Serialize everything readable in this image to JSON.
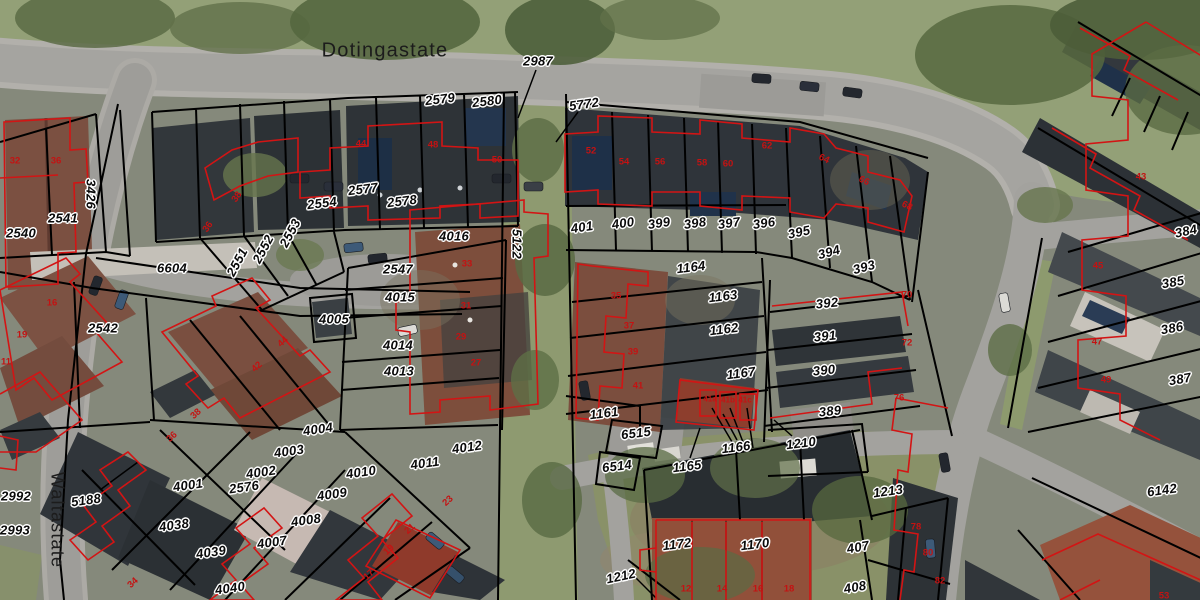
{
  "map": {
    "streets": [
      {
        "t": "Dotingastate",
        "x": 385,
        "y": 51,
        "r": 0,
        "fs": 20
      },
      {
        "t": "Waltastate",
        "x": 57,
        "y": 520,
        "r": 90,
        "fs": 18
      }
    ],
    "parcel_labels": [
      {
        "t": "2987",
        "x": 538,
        "y": 61
      },
      {
        "t": "2579",
        "x": 440,
        "y": 99,
        "r": -7
      },
      {
        "t": "2580",
        "x": 487,
        "y": 101,
        "r": -7
      },
      {
        "t": "5772",
        "x": 584,
        "y": 104,
        "r": -8
      },
      {
        "t": "2577",
        "x": 363,
        "y": 189,
        "r": -7
      },
      {
        "t": "2578",
        "x": 402,
        "y": 201,
        "r": -7
      },
      {
        "t": "2554",
        "x": 322,
        "y": 203,
        "r": -7
      },
      {
        "t": "2553",
        "x": 290,
        "y": 233,
        "r": -62
      },
      {
        "t": "2552",
        "x": 263,
        "y": 249,
        "r": -62
      },
      {
        "t": "2551",
        "x": 237,
        "y": 262,
        "r": -62
      },
      {
        "t": "2541",
        "x": 63,
        "y": 218
      },
      {
        "t": "2540",
        "x": 21,
        "y": 233
      },
      {
        "t": "3426",
        "x": 91,
        "y": 194,
        "r": 90
      },
      {
        "t": "6604",
        "x": 172,
        "y": 268
      },
      {
        "t": "2542",
        "x": 103,
        "y": 328
      },
      {
        "t": "2547",
        "x": 398,
        "y": 269
      },
      {
        "t": "4016",
        "x": 454,
        "y": 236
      },
      {
        "t": "4015",
        "x": 400,
        "y": 297
      },
      {
        "t": "4005",
        "x": 334,
        "y": 319
      },
      {
        "t": "4014",
        "x": 398,
        "y": 345
      },
      {
        "t": "4013",
        "x": 399,
        "y": 371
      },
      {
        "t": "5122",
        "x": 517,
        "y": 244,
        "r": 90
      },
      {
        "t": "401",
        "x": 582,
        "y": 227,
        "r": -8
      },
      {
        "t": "400",
        "x": 623,
        "y": 223,
        "r": -8
      },
      {
        "t": "399",
        "x": 659,
        "y": 223,
        "r": -8
      },
      {
        "t": "398",
        "x": 695,
        "y": 223,
        "r": -8
      },
      {
        "t": "397",
        "x": 729,
        "y": 223,
        "r": -8
      },
      {
        "t": "396",
        "x": 764,
        "y": 223,
        "r": -8
      },
      {
        "t": "395",
        "x": 799,
        "y": 232,
        "r": -12
      },
      {
        "t": "394",
        "x": 829,
        "y": 252,
        "r": -15
      },
      {
        "t": "393",
        "x": 864,
        "y": 267,
        "r": -15
      },
      {
        "t": "392",
        "x": 827,
        "y": 303,
        "r": -6
      },
      {
        "t": "391",
        "x": 825,
        "y": 336,
        "r": -6
      },
      {
        "t": "390",
        "x": 824,
        "y": 370,
        "r": -6
      },
      {
        "t": "389",
        "x": 830,
        "y": 411,
        "r": -6
      },
      {
        "t": "1164",
        "x": 691,
        "y": 267,
        "r": -7
      },
      {
        "t": "1163",
        "x": 723,
        "y": 296,
        "r": -7
      },
      {
        "t": "1162",
        "x": 724,
        "y": 329,
        "r": -7
      },
      {
        "t": "1167",
        "x": 741,
        "y": 373,
        "r": -7
      },
      {
        "t": "1161",
        "x": 604,
        "y": 413,
        "r": -7
      },
      {
        "t": "6515",
        "x": 636,
        "y": 433,
        "r": -7
      },
      {
        "t": "6514",
        "x": 617,
        "y": 466,
        "r": -7
      },
      {
        "t": "1165",
        "x": 687,
        "y": 466,
        "r": -7
      },
      {
        "t": "1166",
        "x": 736,
        "y": 447,
        "r": -7
      },
      {
        "t": "1210",
        "x": 801,
        "y": 443,
        "r": -7
      },
      {
        "t": "1172",
        "x": 677,
        "y": 544,
        "r": -7
      },
      {
        "t": "1170",
        "x": 755,
        "y": 544,
        "r": -7
      },
      {
        "t": "1212",
        "x": 621,
        "y": 576,
        "r": -12
      },
      {
        "t": "407",
        "x": 858,
        "y": 547,
        "r": -10
      },
      {
        "t": "408",
        "x": 855,
        "y": 587,
        "r": -10
      },
      {
        "t": "1213",
        "x": 888,
        "y": 491,
        "r": -8
      },
      {
        "t": "6142",
        "x": 1162,
        "y": 490,
        "r": -8
      },
      {
        "t": "384",
        "x": 1186,
        "y": 231,
        "r": -12
      },
      {
        "t": "385",
        "x": 1173,
        "y": 282,
        "r": -10
      },
      {
        "t": "386",
        "x": 1172,
        "y": 328,
        "r": -10
      },
      {
        "t": "387",
        "x": 1180,
        "y": 379,
        "r": -10
      },
      {
        "t": "2992",
        "x": 16,
        "y": 496
      },
      {
        "t": "2993",
        "x": 15,
        "y": 530
      },
      {
        "t": "5188",
        "x": 86,
        "y": 500,
        "r": -8
      },
      {
        "t": "4001",
        "x": 188,
        "y": 485,
        "r": -8
      },
      {
        "t": "2576",
        "x": 244,
        "y": 487,
        "r": -8
      },
      {
        "t": "4038",
        "x": 174,
        "y": 525,
        "r": -8
      },
      {
        "t": "4039",
        "x": 211,
        "y": 552,
        "r": -8
      },
      {
        "t": "4040",
        "x": 230,
        "y": 588,
        "r": -8
      },
      {
        "t": "4004",
        "x": 318,
        "y": 429,
        "r": -8
      },
      {
        "t": "4003",
        "x": 289,
        "y": 451,
        "r": -8
      },
      {
        "t": "4002",
        "x": 261,
        "y": 472,
        "r": -8
      },
      {
        "t": "4007",
        "x": 272,
        "y": 542,
        "r": -8
      },
      {
        "t": "4008",
        "x": 306,
        "y": 520,
        "r": -8
      },
      {
        "t": "4009",
        "x": 332,
        "y": 494,
        "r": -8
      },
      {
        "t": "4010",
        "x": 361,
        "y": 472,
        "r": -8
      },
      {
        "t": "4011",
        "x": 425,
        "y": 463,
        "r": -8
      },
      {
        "t": "4012",
        "x": 467,
        "y": 447,
        "r": -8
      }
    ],
    "house_numbers": [
      {
        "t": "32",
        "x": 15,
        "y": 161
      },
      {
        "t": "36",
        "x": 56,
        "y": 161
      },
      {
        "t": "44",
        "x": 361,
        "y": 144
      },
      {
        "t": "48",
        "x": 433,
        "y": 145
      },
      {
        "t": "50",
        "x": 497,
        "y": 160
      },
      {
        "t": "52",
        "x": 591,
        "y": 151
      },
      {
        "t": "54",
        "x": 624,
        "y": 162
      },
      {
        "t": "56",
        "x": 660,
        "y": 162
      },
      {
        "t": "58",
        "x": 702,
        "y": 163
      },
      {
        "t": "60",
        "x": 728,
        "y": 164
      },
      {
        "t": "62",
        "x": 767,
        "y": 146
      },
      {
        "t": "64",
        "x": 824,
        "y": 159,
        "r": 25
      },
      {
        "t": "66",
        "x": 864,
        "y": 181,
        "r": 25
      },
      {
        "t": "68",
        "x": 907,
        "y": 206,
        "r": 25
      },
      {
        "t": "70",
        "x": 907,
        "y": 295
      },
      {
        "t": "72",
        "x": 907,
        "y": 343
      },
      {
        "t": "76",
        "x": 899,
        "y": 398
      },
      {
        "t": "78",
        "x": 916,
        "y": 527
      },
      {
        "t": "80",
        "x": 928,
        "y": 553
      },
      {
        "t": "82",
        "x": 940,
        "y": 581
      },
      {
        "t": "38",
        "x": 237,
        "y": 197,
        "r": -55
      },
      {
        "t": "36",
        "x": 208,
        "y": 227,
        "r": -55
      },
      {
        "t": "44",
        "x": 283,
        "y": 342,
        "r": -42
      },
      {
        "t": "42",
        "x": 257,
        "y": 367,
        "r": -42
      },
      {
        "t": "16",
        "x": 52,
        "y": 303
      },
      {
        "t": "19",
        "x": 22,
        "y": 335
      },
      {
        "t": "11",
        "x": 6,
        "y": 362
      },
      {
        "t": "33",
        "x": 467,
        "y": 264
      },
      {
        "t": "31",
        "x": 466,
        "y": 306
      },
      {
        "t": "29",
        "x": 461,
        "y": 337
      },
      {
        "t": "27",
        "x": 476,
        "y": 363
      },
      {
        "t": "35",
        "x": 616,
        "y": 296
      },
      {
        "t": "37",
        "x": 629,
        "y": 326
      },
      {
        "t": "39",
        "x": 633,
        "y": 352
      },
      {
        "t": "41",
        "x": 638,
        "y": 386
      },
      {
        "t": "41a",
        "x": 710,
        "y": 399,
        "fs": 8
      },
      {
        "t": "41b",
        "x": 728,
        "y": 400,
        "fs": 8
      },
      {
        "t": "41c",
        "x": 745,
        "y": 400,
        "fs": 8
      },
      {
        "t": "23",
        "x": 448,
        "y": 501,
        "r": -42
      },
      {
        "t": "21",
        "x": 410,
        "y": 529,
        "r": -42
      },
      {
        "t": "19",
        "x": 389,
        "y": 550,
        "r": -42
      },
      {
        "t": "17",
        "x": 369,
        "y": 575,
        "r": -42
      },
      {
        "t": "38",
        "x": 196,
        "y": 414,
        "r": -42
      },
      {
        "t": "36",
        "x": 172,
        "y": 437,
        "r": -42
      },
      {
        "t": "34",
        "x": 133,
        "y": 583,
        "r": -42
      },
      {
        "t": "12",
        "x": 686,
        "y": 589
      },
      {
        "t": "14",
        "x": 722,
        "y": 589
      },
      {
        "t": "16",
        "x": 758,
        "y": 589
      },
      {
        "t": "18",
        "x": 789,
        "y": 589
      },
      {
        "t": "43",
        "x": 1141,
        "y": 177
      },
      {
        "t": "45",
        "x": 1098,
        "y": 266
      },
      {
        "t": "47",
        "x": 1097,
        "y": 342
      },
      {
        "t": "49",
        "x": 1106,
        "y": 380
      },
      {
        "t": "53",
        "x": 1164,
        "y": 596
      }
    ],
    "colors": {
      "parcel_line": "#000000",
      "building_outline": "#d31414",
      "parcel_label": "#0a0a0a",
      "halo": "#ffffff",
      "house_number": "#c41212",
      "street_label": "#1c1c1c"
    }
  }
}
